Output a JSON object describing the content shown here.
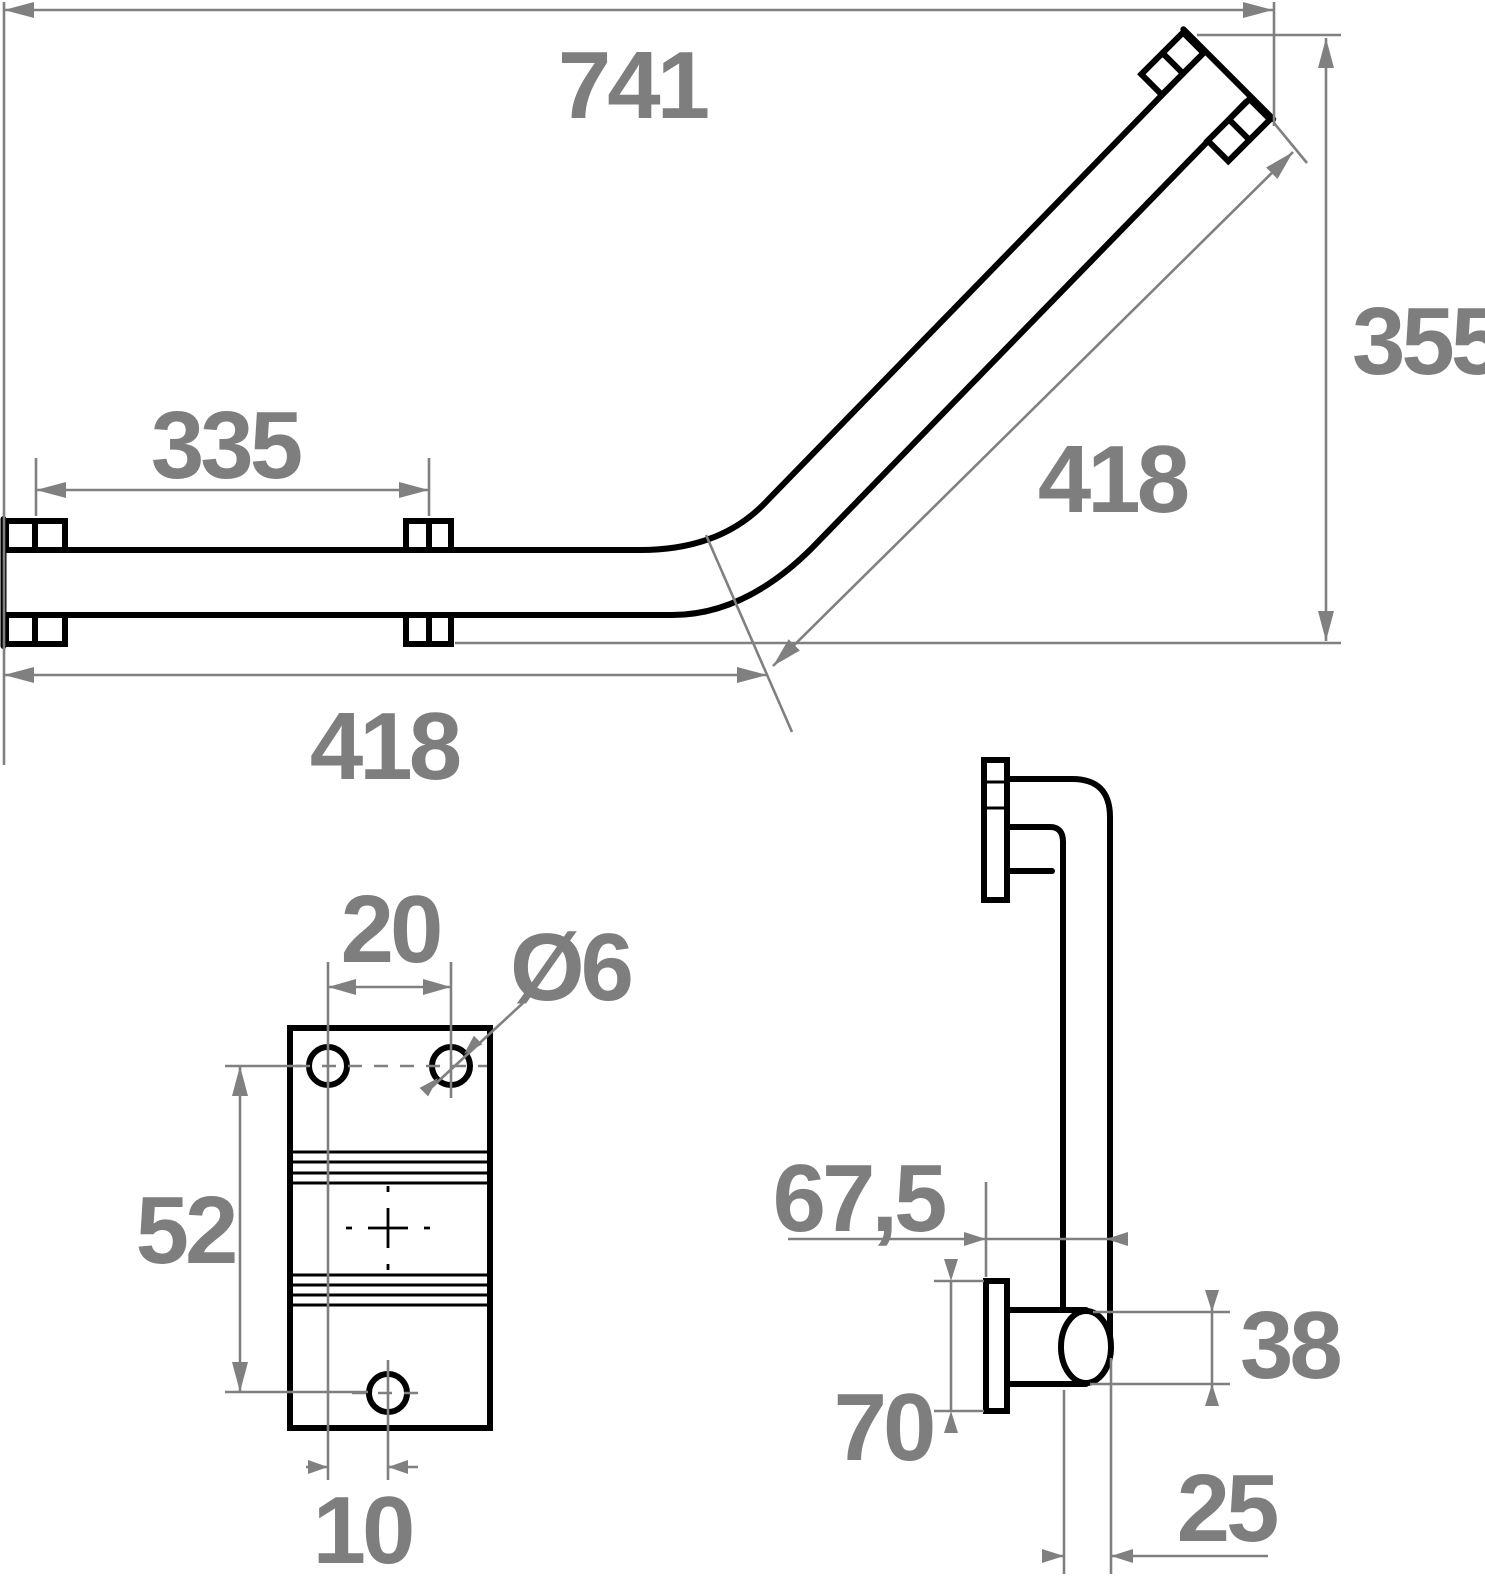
{
  "drawing": {
    "type": "technical-drawing",
    "subject": "135-degree angled grab bar with wall flanges",
    "colors": {
      "line": "#000000",
      "dimension": "#808080",
      "background": "#ffffff"
    },
    "main_view": {
      "overall_width": "741",
      "overall_height": "355",
      "diagonal_length": "418",
      "horizontal_length": "418",
      "fixing_centres": "335"
    },
    "plate_view": {
      "hole_pitch": "20",
      "hole_diameter": "Ø6",
      "vertical_pitch": "52",
      "hole_offset": "10"
    },
    "side_view": {
      "wall_offset": "67,5",
      "flange_height": "70",
      "bar_diameter": "38",
      "bar_depth": "25"
    }
  }
}
